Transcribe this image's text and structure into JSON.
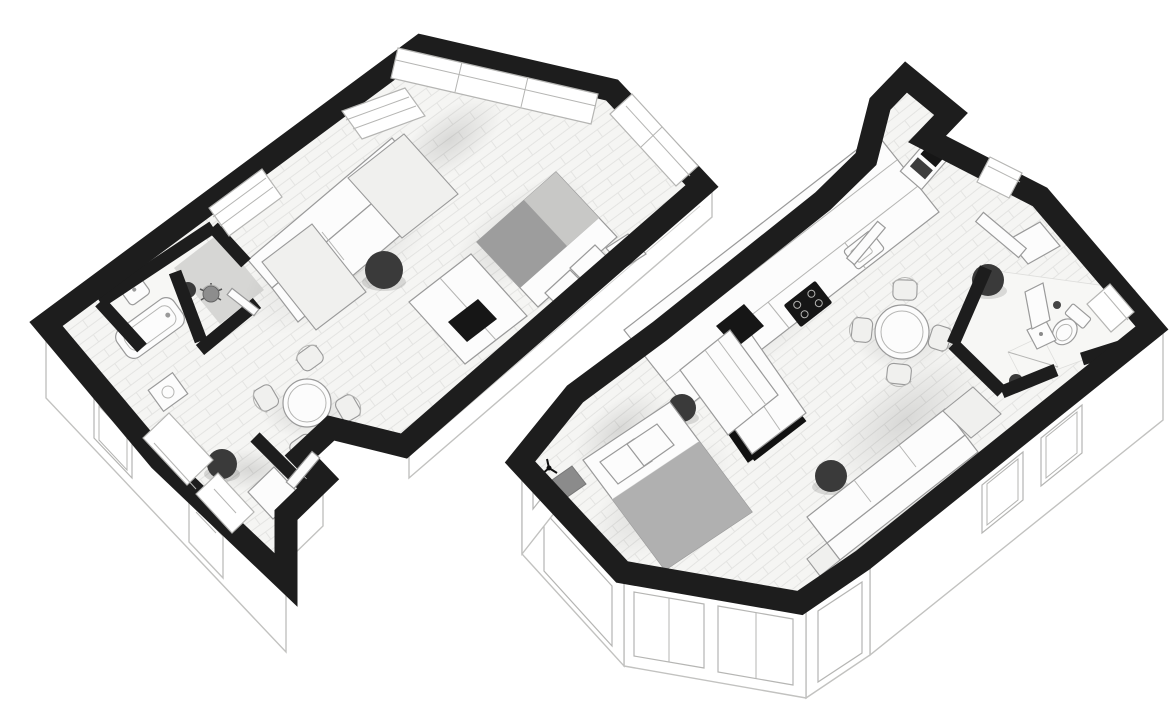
{
  "canvas": {
    "width": 1174,
    "height": 710,
    "background": "#ffffff"
  },
  "theme": {
    "wall_color": "#1d1d1d",
    "floor_color": "#f5f5f3",
    "plank_line": "#dddddb",
    "furniture_fill": "#fcfcfc",
    "furniture_stroke": "#9a9a9a",
    "soft_fill": "#f0f0ee",
    "dark_accent": "#3a3a3a",
    "frame_stroke": "#b5b5b3",
    "face_fill": "#ffffff",
    "face_stroke": "#c2c2c0",
    "tile_fill": "#f7f7f5",
    "study_floor": "#d6d6d4",
    "blanket_base": "#b0b0b0",
    "blanket_dark": "#9d9d9d",
    "blanket_light": "#c8c8c6",
    "page_bg": "#ffffff"
  },
  "plans": [
    {
      "id": "left-unit",
      "view": "axonometric-floor-plan",
      "rooms": [
        "living-area",
        "sleeping-area",
        "dining-area",
        "bathroom",
        "study-nook",
        "entry-hall"
      ],
      "furniture_icons": [
        "sectional-sofa",
        "lounge-cushion",
        "round-ottoman",
        "double-bed",
        "nightstand",
        "tv-cabinet",
        "round-dining-table",
        "dining-chair",
        "dining-chair",
        "dining-chair",
        "dining-chair",
        "bathtub",
        "washbasin",
        "desk-chair",
        "stool",
        "washing-machine",
        "hall-closet"
      ],
      "window_count": 6,
      "door_count": 3,
      "ottoman_count": 2
    },
    {
      "id": "right-unit",
      "view": "axonometric-floor-plan",
      "rooms": [
        "kitchen",
        "dining-area",
        "living-area",
        "sleeping-area",
        "bathroom",
        "entry"
      ],
      "furniture_icons": [
        "kitchen-counter",
        "kitchen-sink",
        "cooktop",
        "oven-column",
        "kitchen-island",
        "bar-stool-block",
        "round-dining-table",
        "dining-chair",
        "dining-chair",
        "dining-chair",
        "dining-chair",
        "side-table",
        "round-ottoman",
        "round-ottoman",
        "round-ottoman",
        "sectional-sofa",
        "double-bed",
        "wardrobe",
        "bench",
        "coat-stand",
        "toilet",
        "shower-tray",
        "washbasin"
      ],
      "window_count": 9,
      "door_count": 4,
      "ottoman_count": 3
    }
  ]
}
